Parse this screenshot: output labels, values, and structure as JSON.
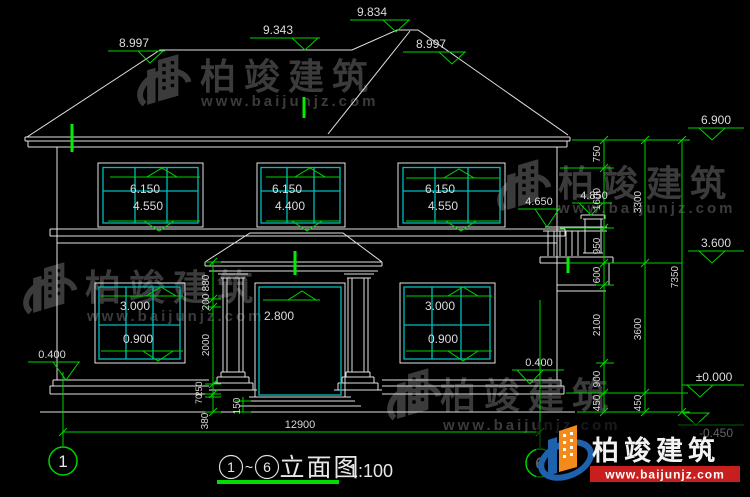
{
  "watermark": {
    "brand": "柏竣建筑",
    "site": "www.baijunjz.com"
  },
  "logo": {
    "brand": "柏竣建筑",
    "site": "www.baijunjz.com"
  },
  "title": {
    "axis_left": "1",
    "tilde": "~",
    "axis_right": "6",
    "name": "立面图",
    "scale": "1:100"
  },
  "grid": {
    "left": "1",
    "right": "6"
  },
  "levels": {
    "roof_left": "8.997",
    "ridge_left": "9.343",
    "ridge_right": "9.834",
    "roof_right": "8.997",
    "eave": "6.900",
    "floor2": "3.600",
    "ground": "±0.000",
    "grade": "-0.450",
    "plinth_left": "0.400",
    "plinth_right": "0.400",
    "balcony_post": "4.850",
    "balcony_rail": "4.650",
    "door_top": "2.800"
  },
  "windows": {
    "f2_left": {
      "top": "6.150",
      "sill": "4.550"
    },
    "f2_mid": {
      "top": "6.150",
      "sill": "4.400"
    },
    "f2_right": {
      "top": "6.150",
      "sill": "4.550"
    },
    "f1_left": {
      "top": "3.000",
      "sill": "0.900"
    },
    "f1_right": {
      "top": "3.000",
      "sill": "0.900"
    }
  },
  "dims": {
    "col1": [
      "750",
      "1600",
      "950",
      "600",
      "2100",
      "900",
      "450"
    ],
    "col2": [
      "3300",
      "3600",
      "450"
    ],
    "col3": "7350",
    "door": [
      "880",
      "200",
      "2000",
      "250",
      "70",
      "380",
      "150"
    ],
    "total_width": "12900"
  }
}
